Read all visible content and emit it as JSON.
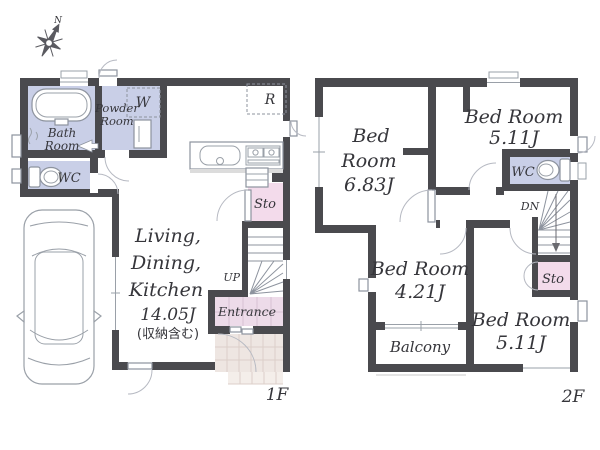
{
  "colors": {
    "wall": "#4a4a4e",
    "room_blue": "#c9cfe7",
    "storage_pink": "#f3dbeb",
    "entrance_pink": "#eddbe9",
    "porch_tile": "#eee6e2",
    "step_tile": "#f4eeea"
  },
  "compass": {
    "north_label": "N"
  },
  "floor1": {
    "floor_label": "1F",
    "bath": {
      "line1": "Bath",
      "line2": "Room"
    },
    "powder": {
      "line1": "Powder",
      "line2": "Room"
    },
    "washer_label": "W",
    "wc_label": "WC",
    "fridge_label": "R",
    "ldk": {
      "line1": "Living,",
      "line2": "Dining,",
      "line3": "Kitchen",
      "line4": "14.05J",
      "line5": "(収納含む)"
    },
    "storage_label": "Sto",
    "stairs_label": "UP",
    "entrance_label": "Entrance"
  },
  "floor2": {
    "floor_label": "2F",
    "bedroom1": {
      "line1": "Bed",
      "line2": "Room",
      "line3": "6.83J"
    },
    "bedroom2": {
      "line1": "Bed Room",
      "line2": "5.11J"
    },
    "bedroom3": {
      "line1": "Bed Room",
      "line2": "4.21J"
    },
    "bedroom4": {
      "line1": "Bed Room",
      "line2": "5.11J"
    },
    "wc_label": "WC",
    "storage_label": "Sto",
    "stairs_label": "DN",
    "balcony_label": "Balcony"
  }
}
